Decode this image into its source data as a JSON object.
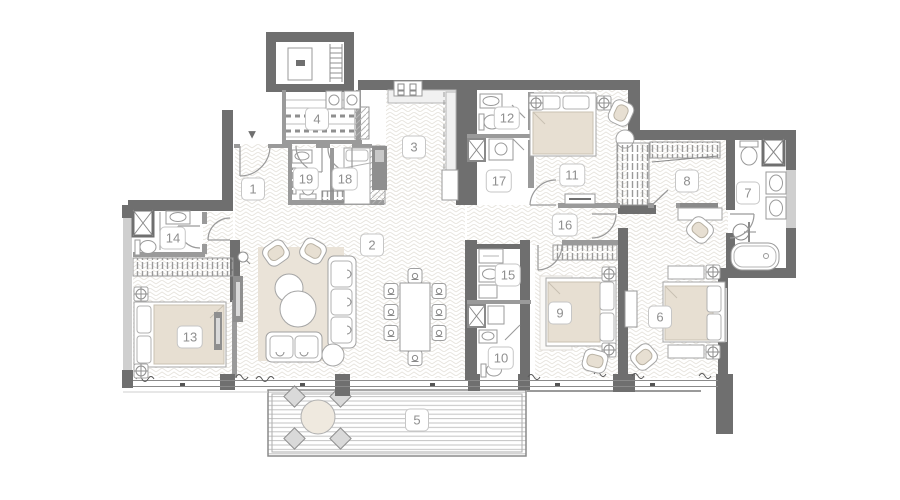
{
  "plan": {
    "entry_marker": "▼",
    "wall_color": "#6f6f6f",
    "partition_color": "#9a9a9a",
    "accent_beige": "#e7dfd2",
    "label_text_color": "#8f8f8f",
    "label_border_color": "#c6c6c6"
  },
  "entry": {
    "x": 252,
    "y": 134
  },
  "rooms": [
    {
      "number": "1",
      "x": 253,
      "y": 189
    },
    {
      "number": "2",
      "x": 372,
      "y": 245
    },
    {
      "number": "3",
      "x": 414,
      "y": 147
    },
    {
      "number": "4",
      "x": 317,
      "y": 119
    },
    {
      "number": "5",
      "x": 417,
      "y": 420
    },
    {
      "number": "6",
      "x": 660,
      "y": 317
    },
    {
      "number": "7",
      "x": 748,
      "y": 193
    },
    {
      "number": "8",
      "x": 687,
      "y": 181
    },
    {
      "number": "9",
      "x": 560,
      "y": 313
    },
    {
      "number": "10",
      "x": 501,
      "y": 358
    },
    {
      "number": "11",
      "x": 572,
      "y": 175
    },
    {
      "number": "12",
      "x": 507,
      "y": 118
    },
    {
      "number": "13",
      "x": 190,
      "y": 337
    },
    {
      "number": "14",
      "x": 173,
      "y": 238
    },
    {
      "number": "15",
      "x": 508,
      "y": 275
    },
    {
      "number": "16",
      "x": 565,
      "y": 225
    },
    {
      "number": "17",
      "x": 499,
      "y": 181
    },
    {
      "number": "18",
      "x": 345,
      "y": 179
    },
    {
      "number": "19",
      "x": 306,
      "y": 179
    }
  ]
}
